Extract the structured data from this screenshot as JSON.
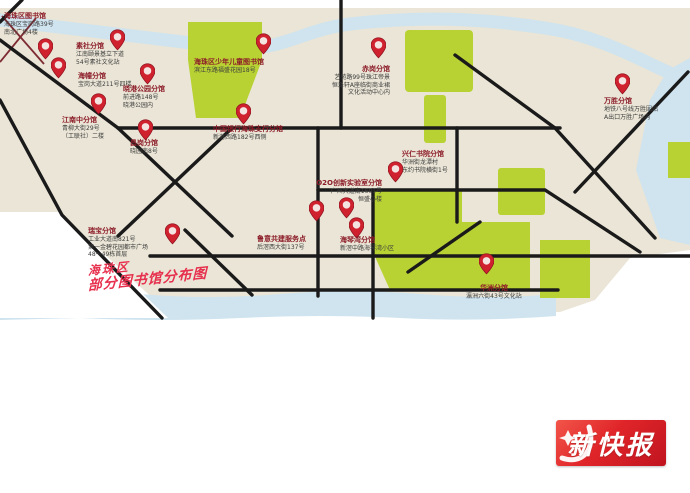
{
  "map": {
    "title": {
      "line1": "海珠区",
      "line2": "部分图书馆分布图"
    },
    "colors": {
      "land": "#eae5d6",
      "water": "#cfe4ef",
      "park": "#b9d233",
      "road": "#1a1a1a",
      "minor_road": "#7e2b33",
      "pin_red": "#d0212f",
      "pin_inner": "#f4e4e1",
      "label_title": "#8c1c28",
      "label_text": "#3c3c3c",
      "map_title_red": "#e7304e",
      "logo_red": "#d6151f"
    },
    "pins": [
      {
        "id": "haizhu-district-library",
        "lines": [
          "海珠区图书馆",
          "海珠区宝岗路39号",
          "南北广场4楼"
        ],
        "pin": {
          "x": 45,
          "y": 45
        },
        "label": {
          "x": 4,
          "y": 12,
          "align": "left"
        }
      },
      {
        "id": "sushe-branch",
        "lines": [
          "素社分馆",
          "江南颐景基立下道",
          "54号素社文化站"
        ],
        "pin": {
          "x": 117,
          "y": 36
        },
        "label": {
          "x": 76,
          "y": 42,
          "align": "left"
        }
      },
      {
        "id": "haichuang-branch",
        "lines": [
          "海幢分馆",
          "宝岗大道211号四楼"
        ],
        "pin": {
          "x": 58,
          "y": 64
        },
        "label": {
          "x": 78,
          "y": 72,
          "align": "left"
        }
      },
      {
        "id": "jiangnanzhong-branch",
        "lines": [
          "江南中分馆",
          "青柳大街29号",
          "（工联社）二楼"
        ],
        "pin": {
          "x": 98,
          "y": 100
        },
        "label": {
          "x": 62,
          "y": 116,
          "align": "left"
        }
      },
      {
        "id": "changgang-branch",
        "lines": [
          "昌岗分馆",
          "晓园南8号"
        ],
        "pin": {
          "x": 145,
          "y": 126
        },
        "label": {
          "x": 130,
          "y": 139,
          "align": "left"
        }
      },
      {
        "id": "xiaogang-park-branch",
        "lines": [
          "晓港公园分馆",
          "前进路148号",
          "晓港公园内"
        ],
        "pin": {
          "x": 147,
          "y": 70
        },
        "label": {
          "x": 123,
          "y": 85,
          "align": "left"
        }
      },
      {
        "id": "children-library",
        "lines": [
          "海珠区少年儿童图书馆",
          "滨江东路福盛花园18号"
        ],
        "pin": {
          "x": 263,
          "y": 40
        },
        "label": {
          "x": 194,
          "y": 58,
          "align": "left"
        }
      },
      {
        "id": "boc-haizhu-branch",
        "lines": [
          "中国银行海珠支行分馆",
          "新港西路182号西侧"
        ],
        "pin": {
          "x": 243,
          "y": 110
        },
        "label": {
          "x": 213,
          "y": 125,
          "align": "left"
        }
      },
      {
        "id": "chigang-branch",
        "lines": [
          "赤岗分馆",
          "艺苑路99号珠江帝景",
          "恒泽轩A座临街商业裙",
          "文化活动中心内"
        ],
        "pin": {
          "x": 378,
          "y": 44
        },
        "label": {
          "x": 318,
          "y": 65,
          "w": 72,
          "align": "right"
        }
      },
      {
        "id": "wansheng-branch",
        "lines": [
          "万胜分馆",
          "地铁八号线万胜围站",
          "A出口万胜广场内"
        ],
        "pin": {
          "x": 622,
          "y": 80
        },
        "label": {
          "x": 604,
          "y": 97,
          "align": "left"
        }
      },
      {
        "id": "xingren-academy-branch",
        "lines": [
          "兴仁书院分馆",
          "华洲街龙潭村",
          "东约书院横街1号"
        ],
        "pin": {
          "x": 395,
          "y": 168
        },
        "label": {
          "x": 402,
          "y": 150,
          "align": "left"
        }
      },
      {
        "id": "o2o-lab-branch",
        "lines": [
          "O2O创新实验室分馆",
          "广州大道南1601号",
          "恒盛小楼"
        ],
        "pin": {
          "x": 346,
          "y": 204
        },
        "label": {
          "x": 312,
          "y": 179,
          "w": 70,
          "align": "right"
        }
      },
      {
        "id": "luyi-service-point",
        "lines": [
          "鲁意共建服务点",
          "后滘西大街137号"
        ],
        "pin": {
          "x": 316,
          "y": 207
        },
        "label": {
          "x": 257,
          "y": 235,
          "align": "left"
        }
      },
      {
        "id": "haiqinwan-branch",
        "lines": [
          "海琴湾分馆",
          "新滘中路海琴湾小区"
        ],
        "pin": {
          "x": 356,
          "y": 224
        },
        "label": {
          "x": 340,
          "y": 236,
          "align": "left"
        }
      },
      {
        "id": "ruibao-branch",
        "lines": [
          "瑞宝分馆",
          "工业大道南821号",
          "第一金碧花园都市广场",
          "48～49栋首层"
        ],
        "pin": {
          "x": 172,
          "y": 230
        },
        "label": {
          "x": 88,
          "y": 227,
          "align": "left"
        }
      },
      {
        "id": "huazhou-branch",
        "lines": [
          "华洲分馆",
          "瀛洲六街43号文化站"
        ],
        "pin": {
          "x": 486,
          "y": 260
        },
        "label": {
          "x": 462,
          "y": 284,
          "w": 64,
          "align": "center"
        }
      }
    ]
  },
  "logo": {
    "text": "新快报"
  }
}
